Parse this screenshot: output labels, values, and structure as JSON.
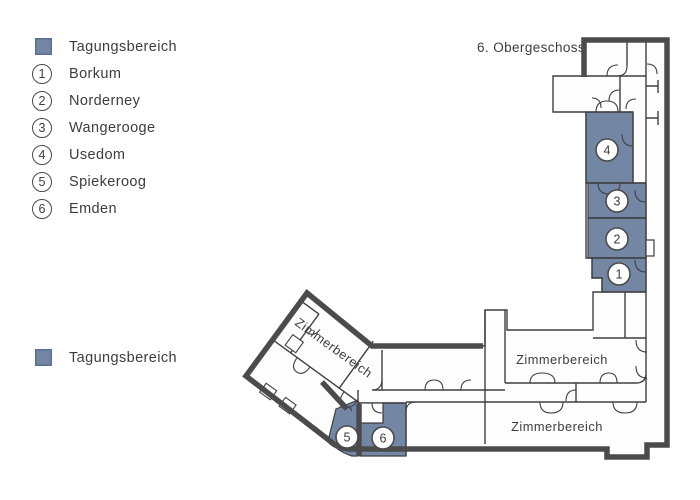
{
  "colors": {
    "tagungsbereich": "#7387a5",
    "tagungsbereich_border": "#5a6f94",
    "wall": "#4b4b4d",
    "wall_thin": "#3f3f42",
    "text": "#3d3d3f"
  },
  "legend": {
    "area_label": "Tagungsbereich",
    "items": [
      {
        "num": "1",
        "label": "Borkum"
      },
      {
        "num": "2",
        "label": "Norderney"
      },
      {
        "num": "3",
        "label": "Wangerooge"
      },
      {
        "num": "4",
        "label": "Usedom"
      },
      {
        "num": "5",
        "label": "Spiekeroog"
      },
      {
        "num": "6",
        "label": "Emden"
      }
    ],
    "secondary_area_label": "Tagungsbereich"
  },
  "plan": {
    "floor_label": "6. Obergeschoss",
    "room_markers": [
      "1",
      "2",
      "3",
      "4",
      "5",
      "6"
    ],
    "area_labels": {
      "wing": "Zimmerbereich",
      "upper": "Zimmerbereich",
      "lower": "Zimmerbereich"
    }
  }
}
